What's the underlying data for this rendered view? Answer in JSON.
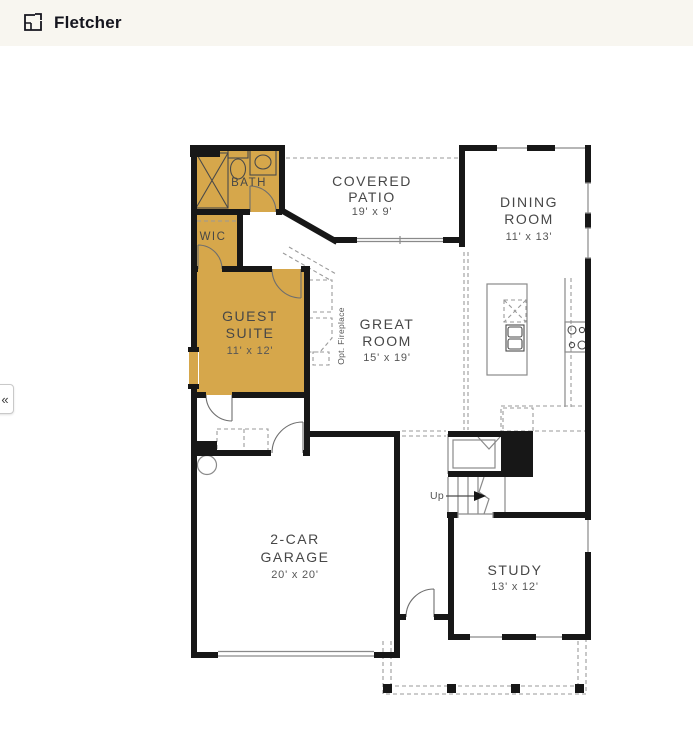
{
  "header": {
    "title": "Fletcher"
  },
  "sidebar_toggle": {
    "glyph": "«"
  },
  "plan": {
    "rooms": {
      "bath": {
        "name": "BATH"
      },
      "wic": {
        "name": "WIC"
      },
      "guest": {
        "line1": "GUEST",
        "line2": "SUITE",
        "dims": "11' x 12'"
      },
      "patio": {
        "line1": "COVERED",
        "line2": "PATIO",
        "dims": "19' x 9'"
      },
      "dining": {
        "line1": "DINING",
        "line2": "ROOM",
        "dims": "11' x 13'"
      },
      "great": {
        "line1": "GREAT",
        "line2": "ROOM",
        "dims": "15' x 19'"
      },
      "garage": {
        "line1": "2-CAR",
        "line2": "GARAGE",
        "dims": "20' x 20'"
      },
      "study": {
        "name": "STUDY",
        "dims": "13' x 12'"
      }
    },
    "annotations": {
      "fireplace": "Opt. Fireplace",
      "stairs_up": "Up"
    }
  },
  "theme": {
    "highlight": "#D6A74B",
    "wall": "#171717",
    "line": "#8A8A8A",
    "label": "#474747",
    "header_bg": "#F8F6F0"
  }
}
